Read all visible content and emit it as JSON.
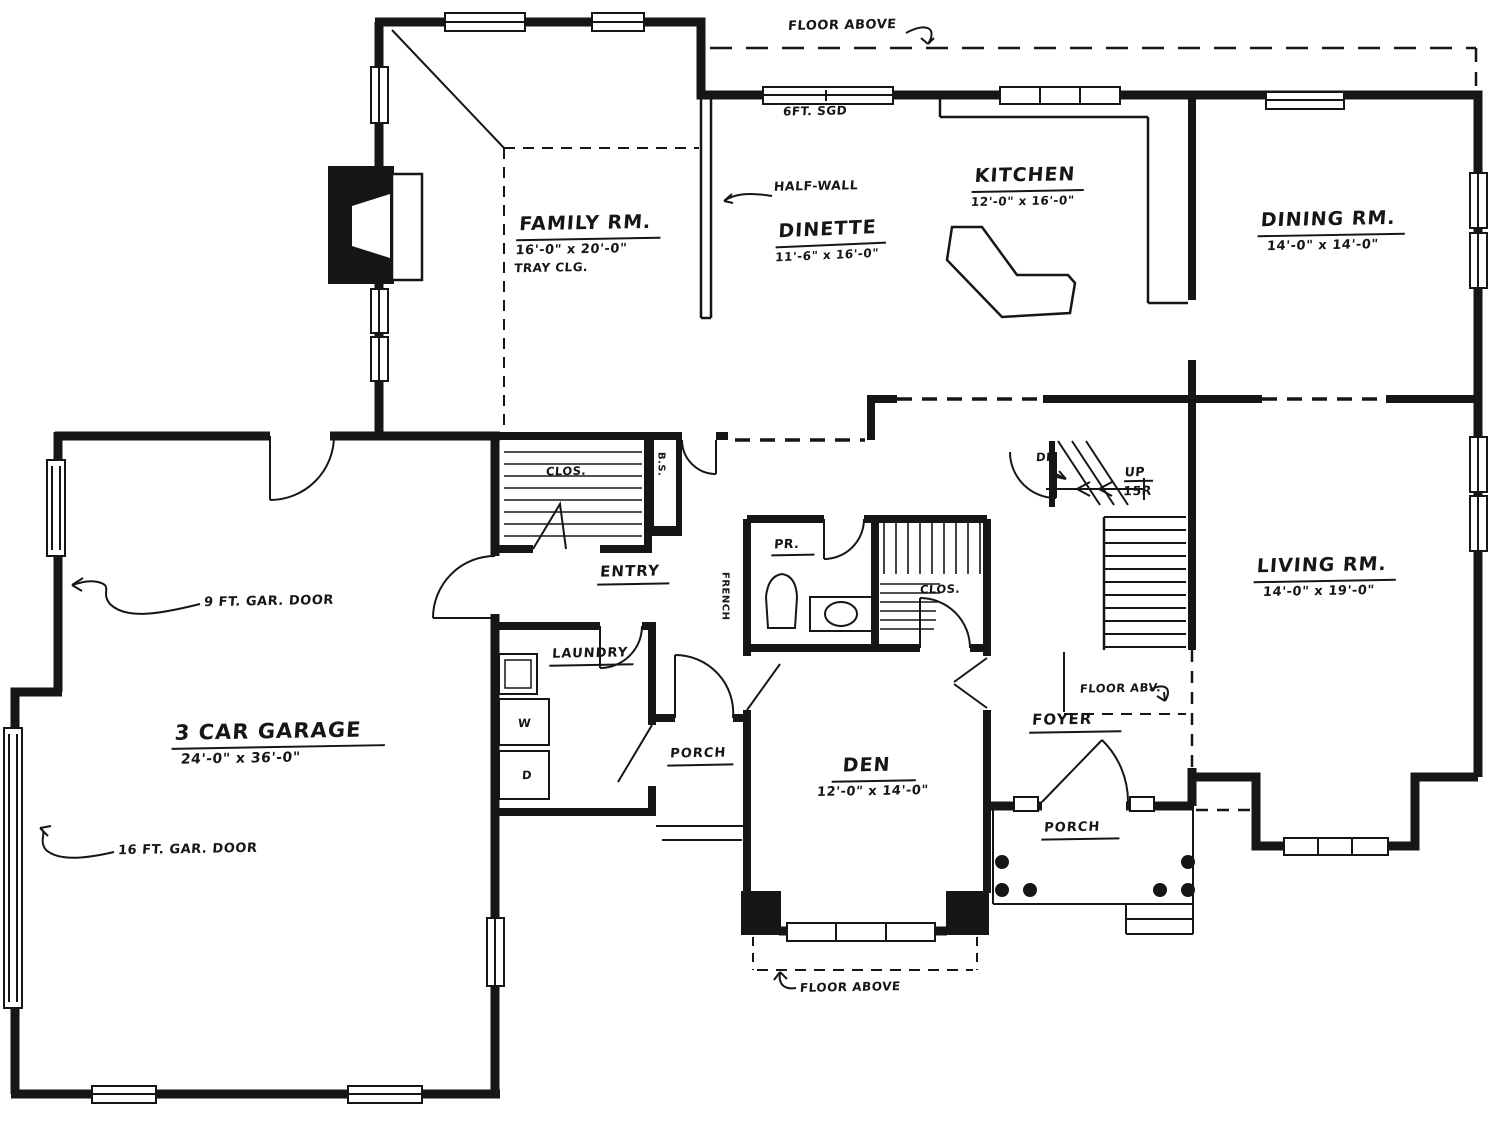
{
  "rooms": {
    "family": {
      "name": "FAMILY RM.",
      "dims": "16'-0\" x 20'-0\"",
      "note": "TRAY CLG."
    },
    "dinette": {
      "name": "DINETTE",
      "dims": "11'-6\" x 16'-0\""
    },
    "kitchen": {
      "name": "KITCHEN",
      "dims": "12'-0\" x 16'-0\""
    },
    "dining": {
      "name": "DINING RM.",
      "dims": "14'-0\" x 14'-0\""
    },
    "living": {
      "name": "LIVING RM.",
      "dims": "14'-0\" x 19'-0\""
    },
    "den": {
      "name": "DEN",
      "dims": "12'-0\" x 14'-0\""
    },
    "garage": {
      "name": "3 CAR GARAGE",
      "dims": "24'-0\" x 36'-0\""
    },
    "entry": {
      "name": "ENTRY"
    },
    "foyer": {
      "name": "FOYER"
    },
    "laundry": {
      "name": "LAUNDRY"
    },
    "powder": {
      "name": "PR."
    },
    "entry_closet": {
      "name": "CLOS."
    },
    "hall_closet": {
      "name": "CLOS."
    },
    "rear_porch": {
      "name": "PORCH"
    },
    "front_porch": {
      "name": "PORCH"
    }
  },
  "annotations": {
    "floor_above_top": "FLOOR ABOVE",
    "sliding_glass_door": "6FT. SGD",
    "half_wall": "HALF-WALL",
    "floor_abv_foyer": "FLOOR ABV.",
    "floor_above_den": "FLOOR ABOVE",
    "garage_door_9ft": "9 FT. GAR. DOOR",
    "garage_door_16ft": "16 FT. GAR. DOOR",
    "stair_down": "DN",
    "stair_up": "UP",
    "stair_risers": "15R",
    "washer": "W",
    "dryer": "D",
    "bookshelf": "B.S.",
    "french_door": "FRENCH"
  },
  "colors": {
    "ink": "#161616",
    "paper": "#ffffff"
  }
}
